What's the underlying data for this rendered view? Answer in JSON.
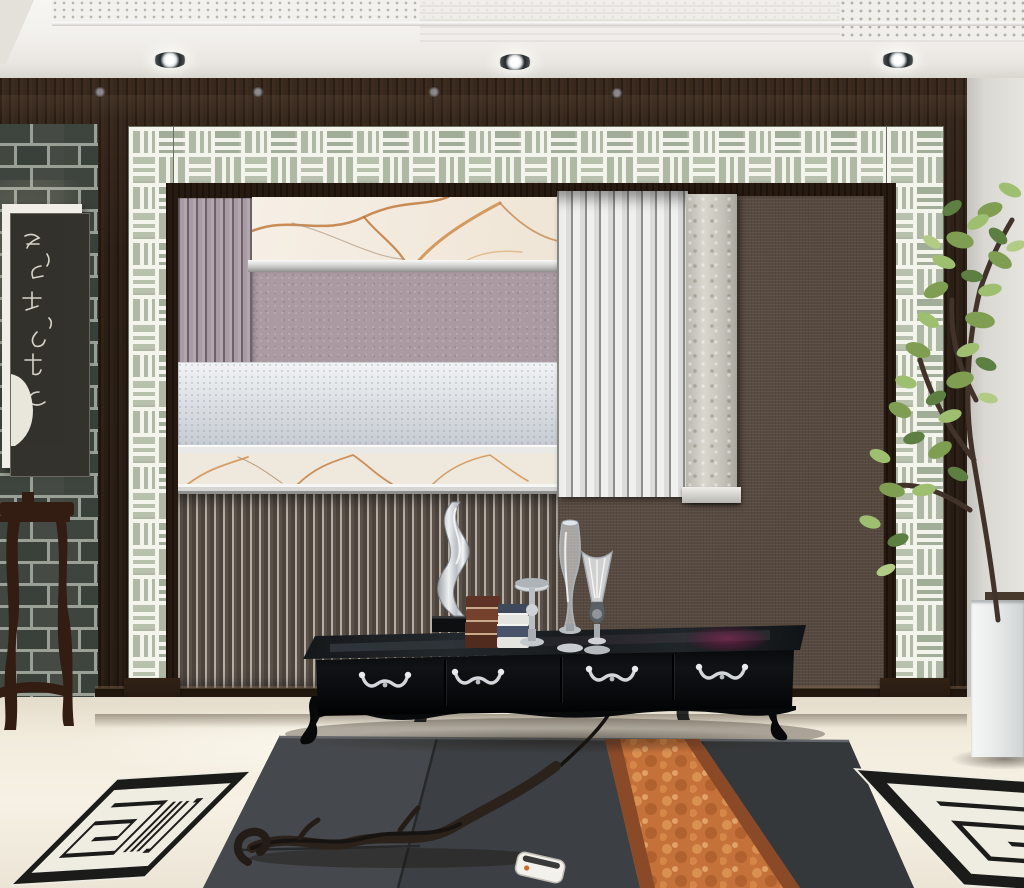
{
  "scene": {
    "title": "Modern Chinese living room with decorative TV feature wall",
    "style": "new-Chinese interior visualization, no on-screen text"
  },
  "ceiling": {
    "type": "recessed tray ceiling with perforated acoustic panel",
    "spotlight_count": 3
  },
  "feature_wall": {
    "frame": "dark espresso wood surround",
    "border": "white geometric lattice fretwork over celadon glass",
    "panels": [
      "gold-veined white marble header",
      "fluted mauve pilaster",
      "mauve stucco panel",
      "silver-leaf sparkle band",
      "gold-veined marble ledge",
      "white striped wainscot panel",
      "travertine pilaster",
      "dark brown linen panel",
      "ribbed charcoal lower panel"
    ]
  },
  "left_wall": {
    "material": "dark grey brick",
    "artwork": "framed Chinese calligraphy rubbing with white mat and dark wood frame",
    "furniture": "dark rosewood flower stand"
  },
  "console": {
    "finish": "glossy black lacquer TV cabinet",
    "drawer_count": 4,
    "handle_style": "silver swan-neck pulls",
    "decor_items": [
      "twisted silver sculpture on black plinth",
      "stack of brown books",
      "stack of blue-and-white books",
      "silver candlestick stand",
      "tall clear glass vase",
      "fluted glass goblet vase"
    ]
  },
  "floor": {
    "tile": "cream polished tile",
    "mats": "charcoal grey woven floor mats",
    "runner": "rust-orange patterned runner",
    "rugs": [
      "black and white Greek-key rug (left)",
      "black and white Greek-key rug (right)"
    ],
    "accents": [
      "driftwood branch sculpture",
      "white remote control",
      "black cable"
    ]
  },
  "right_side": {
    "plant": "potted green indoor tree",
    "planter": "white cube planter",
    "wall": "light grey wall"
  },
  "palette": {
    "wood": "#2c1f16",
    "brick": "#3e443e",
    "lattice_glass": "#aeb8a5",
    "lattice_fret": "#f3f4ec",
    "marble": "#f3ece1",
    "marble_vein": "#c07a3c",
    "mauve": "#a99aa2",
    "silver_band": "#dfe3e6",
    "linen": "#55483e",
    "striped_panel": "#ededeb",
    "floor": "#efe9db",
    "mat": "#3c4044",
    "runner": "#c4713a",
    "rug_black": "#1b1b19",
    "leaf_green": "#82a258"
  }
}
